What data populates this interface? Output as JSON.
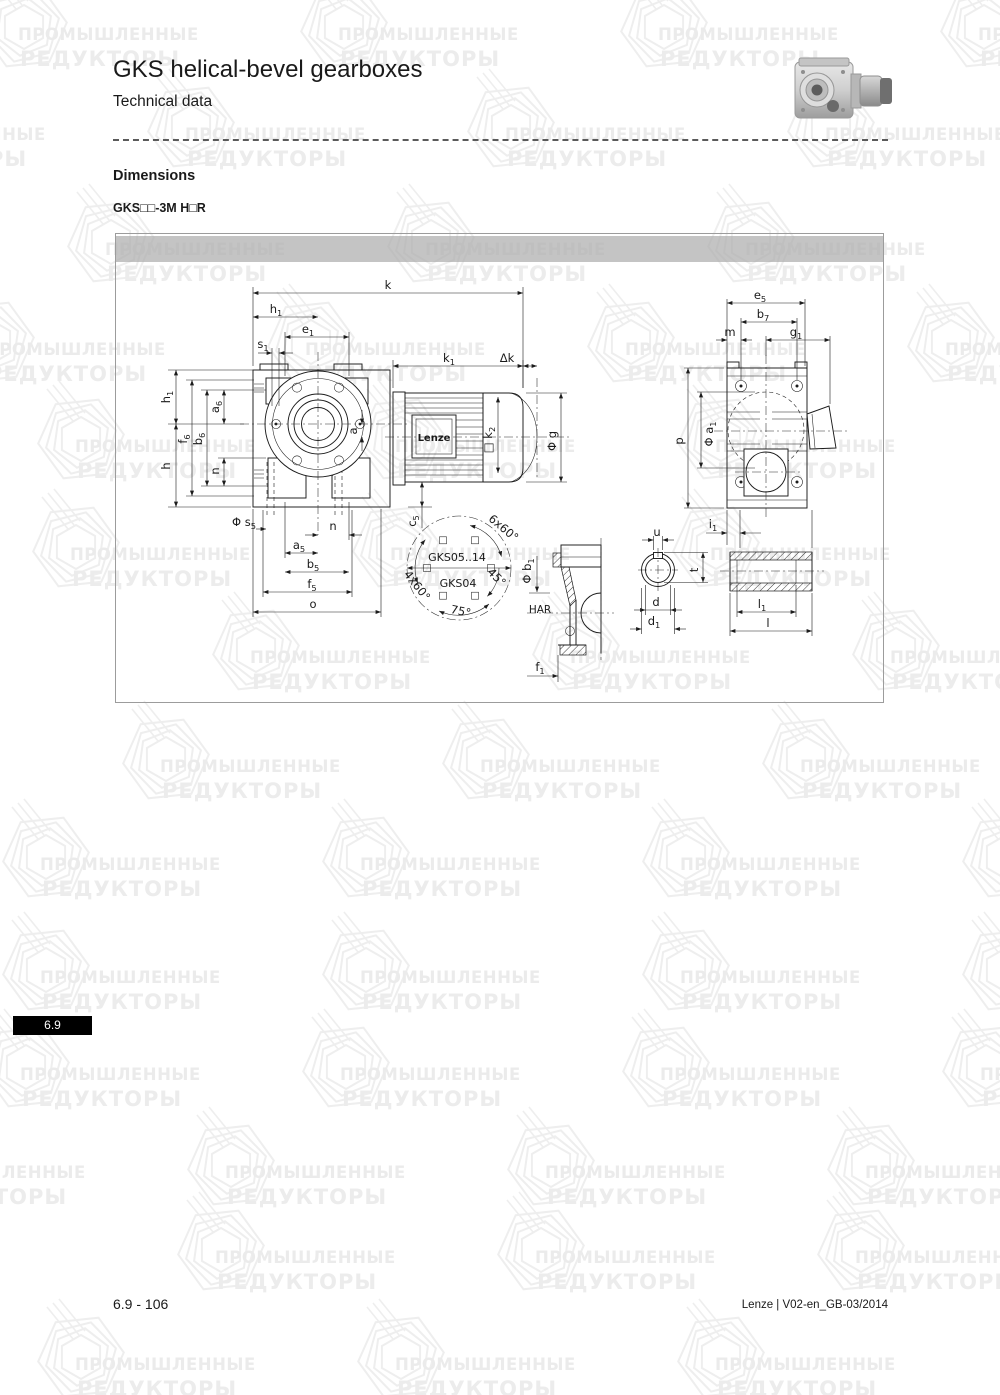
{
  "page": {
    "title": "GKS helical-bevel gearboxes",
    "subtitle": "Technical data",
    "section_heading": "Dimensions",
    "variant_code": "GKS□□-3M H□R",
    "page_number": "6.9 - 106",
    "doc_reference": "Lenze | V02-en_GB-03/2014",
    "side_tab": "6.9"
  },
  "watermark": {
    "line1": "ПРОМЫШЛЕННЫЕ",
    "line2": "РЕДУКТОРЫ",
    "color": "#ebebeb",
    "rows": [
      {
        "y": 25,
        "xs": [
          18,
          338,
          658,
          978
        ]
      },
      {
        "y": 125,
        "xs": [
          -135,
          185,
          505,
          825
        ]
      },
      {
        "y": 240,
        "xs": [
          105,
          425,
          745
        ]
      },
      {
        "y": 340,
        "xs": [
          -15,
          305,
          625,
          945
        ]
      },
      {
        "y": 437,
        "xs": [
          75,
          395,
          715
        ]
      },
      {
        "y": 545,
        "xs": [
          70,
          390,
          710
        ]
      },
      {
        "y": 648,
        "xs": [
          250,
          570,
          890
        ]
      },
      {
        "y": 757,
        "xs": [
          160,
          480,
          800
        ]
      },
      {
        "y": 855,
        "xs": [
          40,
          360,
          680,
          1000
        ]
      },
      {
        "y": 968,
        "xs": [
          40,
          360,
          680,
          1000
        ]
      },
      {
        "y": 1065,
        "xs": [
          20,
          340,
          660,
          980
        ]
      },
      {
        "y": 1163,
        "xs": [
          -95,
          225,
          545,
          865
        ]
      },
      {
        "y": 1248,
        "xs": [
          215,
          535,
          855
        ]
      },
      {
        "y": 1355,
        "xs": [
          75,
          395,
          715
        ]
      }
    ]
  },
  "drawing": {
    "accent_bar_color": "#c3c3c3",
    "motor_brand": "Lenze",
    "labels": [
      {
        "p": [
          [
            "k"
          ]
        ],
        "x": 388,
        "y": 289
      },
      {
        "p": [
          [
            "h"
          ],
          [
            "1",
            "s"
          ]
        ],
        "x": 276,
        "y": 313
      },
      {
        "p": [
          [
            "e"
          ],
          [
            "1",
            "s"
          ]
        ],
        "x": 308,
        "y": 333
      },
      {
        "p": [
          [
            "s"
          ],
          [
            "1",
            "s"
          ]
        ],
        "x": 263,
        "y": 348
      },
      {
        "p": [
          [
            "h"
          ],
          [
            "1",
            "s"
          ]
        ],
        "x": 170,
        "y": 397,
        "r": -90
      },
      {
        "p": [
          [
            "f"
          ],
          [
            "6",
            "s"
          ]
        ],
        "x": 187,
        "y": 439,
        "r": -90
      },
      {
        "p": [
          [
            "b"
          ],
          [
            "6",
            "s"
          ]
        ],
        "x": 202,
        "y": 439,
        "r": -90
      },
      {
        "p": [
          [
            "a"
          ],
          [
            "6",
            "s"
          ]
        ],
        "x": 219,
        "y": 407,
        "r": -90
      },
      {
        "p": [
          [
            "h"
          ]
        ],
        "x": 170,
        "y": 466,
        "r": -90
      },
      {
        "p": [
          [
            "n"
          ]
        ],
        "x": 219,
        "y": 471,
        "r": -90
      },
      {
        "p": [
          [
            "a"
          ]
        ],
        "x": 357,
        "y": 431,
        "r": -90
      },
      {
        "p": [
          [
            "Φ s"
          ],
          [
            "5",
            "s"
          ]
        ],
        "x": 244,
        "y": 526
      },
      {
        "p": [
          [
            "n"
          ]
        ],
        "x": 333,
        "y": 530
      },
      {
        "p": [
          [
            "a"
          ],
          [
            "5",
            "s"
          ]
        ],
        "x": 299,
        "y": 549
      },
      {
        "p": [
          [
            "b"
          ],
          [
            "5",
            "s"
          ]
        ],
        "x": 313,
        "y": 568
      },
      {
        "p": [
          [
            "f"
          ],
          [
            "5",
            "s"
          ]
        ],
        "x": 312,
        "y": 588
      },
      {
        "p": [
          [
            "o"
          ]
        ],
        "x": 313,
        "y": 608
      },
      {
        "p": [
          [
            "k"
          ],
          [
            "1",
            "s"
          ]
        ],
        "x": 449,
        "y": 362
      },
      {
        "p": [
          [
            "Δk"
          ]
        ],
        "x": 507,
        "y": 362
      },
      {
        "p": [
          [
            "□ k"
          ],
          [
            "2",
            "s"
          ]
        ],
        "x": 492,
        "y": 440,
        "r": -90
      },
      {
        "p": [
          [
            "Φ g"
          ]
        ],
        "x": 556,
        "y": 441,
        "r": -90
      },
      {
        "p": [
          [
            "c"
          ],
          [
            "5",
            "s"
          ]
        ],
        "x": 416,
        "y": 521,
        "r": -90
      },
      {
        "p": [
          [
            "Lenze"
          ]
        ],
        "x": 434,
        "y": 441,
        "b": 1,
        "s": 10
      },
      {
        "p": [
          [
            "e"
          ],
          [
            "5",
            "s"
          ]
        ],
        "x": 760,
        "y": 299
      },
      {
        "p": [
          [
            "b"
          ],
          [
            "7",
            "s"
          ]
        ],
        "x": 763,
        "y": 318
      },
      {
        "p": [
          [
            "m"
          ]
        ],
        "x": 730,
        "y": 336
      },
      {
        "p": [
          [
            "g"
          ],
          [
            "1",
            "s"
          ]
        ],
        "x": 796,
        "y": 336
      },
      {
        "p": [
          [
            "p"
          ]
        ],
        "x": 683,
        "y": 441,
        "r": -90
      },
      {
        "p": [
          [
            "Φ a"
          ],
          [
            "1",
            "s"
          ]
        ],
        "x": 713,
        "y": 434,
        "r": -90
      },
      {
        "p": [
          [
            "i"
          ],
          [
            "1",
            "s"
          ]
        ],
        "x": 713,
        "y": 528
      },
      {
        "p": [
          [
            "GKS05..14"
          ]
        ],
        "x": 457,
        "y": 561,
        "s": 11
      },
      {
        "p": [
          [
            "GKS04"
          ]
        ],
        "x": 458,
        "y": 587,
        "s": 11
      },
      {
        "p": [
          [
            "6x60°"
          ]
        ],
        "x": 501,
        "y": 531,
        "r": 40
      },
      {
        "p": [
          [
            "4x60°"
          ]
        ],
        "x": 414,
        "y": 588,
        "r": 52
      },
      {
        "p": [
          [
            "45°"
          ]
        ],
        "x": 494,
        "y": 580,
        "r": 45
      },
      {
        "p": [
          [
            "75°"
          ]
        ],
        "x": 460,
        "y": 615,
        "r": 12
      },
      {
        "p": [
          [
            "Φ b"
          ],
          [
            "1",
            "s"
          ]
        ],
        "x": 531,
        "y": 571,
        "r": -90
      },
      {
        "p": [
          [
            "HAR"
          ]
        ],
        "x": 540,
        "y": 613,
        "s": 10.5
      },
      {
        "p": [
          [
            "f"
          ],
          [
            "1",
            "s"
          ]
        ],
        "x": 540,
        "y": 671
      },
      {
        "p": [
          [
            "u"
          ]
        ],
        "x": 657,
        "y": 536
      },
      {
        "p": [
          [
            "t"
          ]
        ],
        "x": 698,
        "y": 570,
        "r": -90
      },
      {
        "p": [
          [
            "d"
          ]
        ],
        "x": 656,
        "y": 606
      },
      {
        "p": [
          [
            "d"
          ],
          [
            "1",
            "s"
          ]
        ],
        "x": 654,
        "y": 625
      },
      {
        "p": [
          [
            "l"
          ],
          [
            "1",
            "s"
          ]
        ],
        "x": 762,
        "y": 608
      },
      {
        "p": [
          [
            "l"
          ]
        ],
        "x": 768,
        "y": 627
      }
    ]
  }
}
